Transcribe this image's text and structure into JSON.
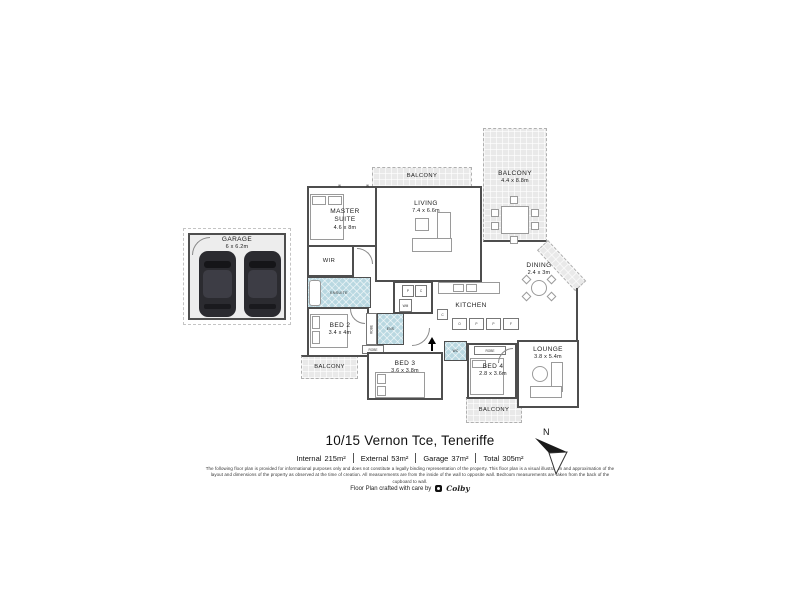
{
  "plan": {
    "garage": {
      "name": "GARAGE",
      "dims": "6 x 6.2m"
    },
    "balcony_top": {
      "name": "BALCONY"
    },
    "balcony_main": {
      "name": "BALCONY",
      "dims": "4.4 x 8.8m"
    },
    "balcony_left": {
      "name": "BALCONY"
    },
    "balcony_bottom": {
      "name": "BALCONY"
    },
    "master_suite": {
      "name": "MASTER SUITE",
      "dims": "4.6 x 8m"
    },
    "living": {
      "name": "LIVING",
      "dims": "7.4 x 6.6m"
    },
    "wir": {
      "name": "WIR"
    },
    "ensuite": {
      "name": "ENSUITE"
    },
    "ens": {
      "name": "ENS"
    },
    "wc": {
      "name": "WC"
    },
    "dining": {
      "name": "DINING",
      "dims": "2.4 x 3m"
    },
    "kitchen": {
      "name": "KITCHEN"
    },
    "lounge": {
      "name": "LOUNGE",
      "dims": "3.8 x 5.4m"
    },
    "bed2": {
      "name": "BED 2",
      "dims": "3.4 x 4m"
    },
    "bed3": {
      "name": "BED 3",
      "dims": "3.6 x 3.8m"
    },
    "bed4": {
      "name": "BED 4",
      "dims": "2.8 x 3.6m"
    },
    "robe": "ROBE",
    "wm": "WM",
    "window_marker": "W",
    "laundry_cupboards": [
      "P",
      "C"
    ],
    "kitchen_units": [
      "C",
      "O",
      "P",
      "P",
      "F"
    ]
  },
  "footer": {
    "title": "10/15 Vernon Tce, Teneriffe",
    "areas": [
      {
        "label": "Internal",
        "value": "215m²"
      },
      {
        "label": "External",
        "value": "53m²"
      },
      {
        "label": "Garage",
        "value": "37m²"
      },
      {
        "label": "Total",
        "value": "305m²"
      }
    ],
    "disclaimer": "The following floor plan is provided for informational purposes only and does not constitute a legally binding representation of the property. This floor plan is a visual illustration and approximation of the layout and dimensions of the property as observed at the time of creation. All measurements are from the inside of the wall to opposite wall. Bedroom measurements are taken from the back of the cupboard to wall.",
    "credit": "Floor Plan crafted with care by",
    "brand": "Colby",
    "compass_label": "N"
  }
}
